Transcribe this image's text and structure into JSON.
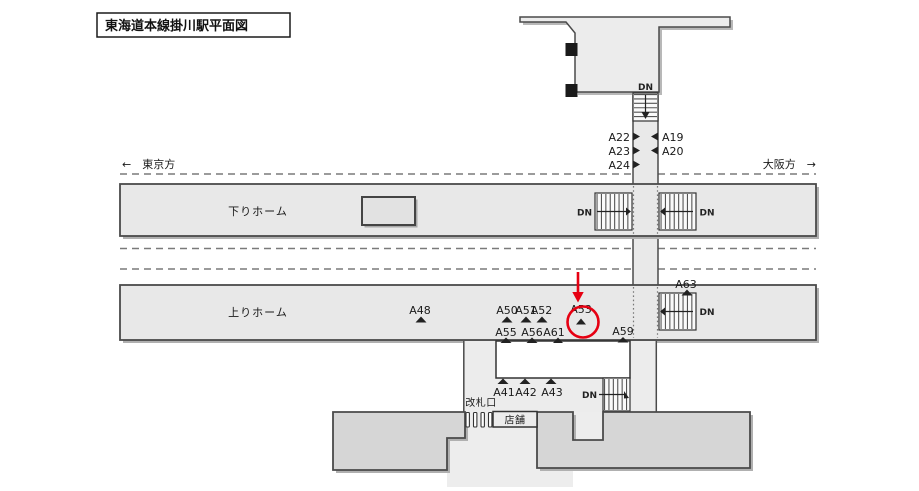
{
  "title": "東海道本線掛川駅平面図",
  "directions": {
    "tokyo": "←　東京方",
    "osaka": "大阪方　→"
  },
  "platforms": {
    "down": "下りホーム",
    "up": "上りホーム"
  },
  "facilities": {
    "gate": "改札口",
    "shop": "店舗",
    "stairs": "DN"
  },
  "ads": {
    "a19": "A19",
    "a20": "A20",
    "a22": "A22",
    "a23": "A23",
    "a24": "A24",
    "a41": "A41",
    "a42": "A42",
    "a43": "A43",
    "a48": "A48",
    "a50": "A50",
    "a51": "A51",
    "a52": "A52",
    "a53": "A53",
    "a55": "A55",
    "a56": "A56",
    "a59": "A59",
    "a61": "A61",
    "a63": "A63"
  },
  "highlight": {
    "target": "A53",
    "color": "#e60012"
  },
  "colors": {
    "platform_fill": "#e8e8e8",
    "building_fill": "#d6d6d6",
    "concourse_fill": "#ececec",
    "outline": "#4a4a4a",
    "shadow": "#b0b0b0",
    "track_dash": "#7a7a7a",
    "highlight_red": "#e60012"
  }
}
